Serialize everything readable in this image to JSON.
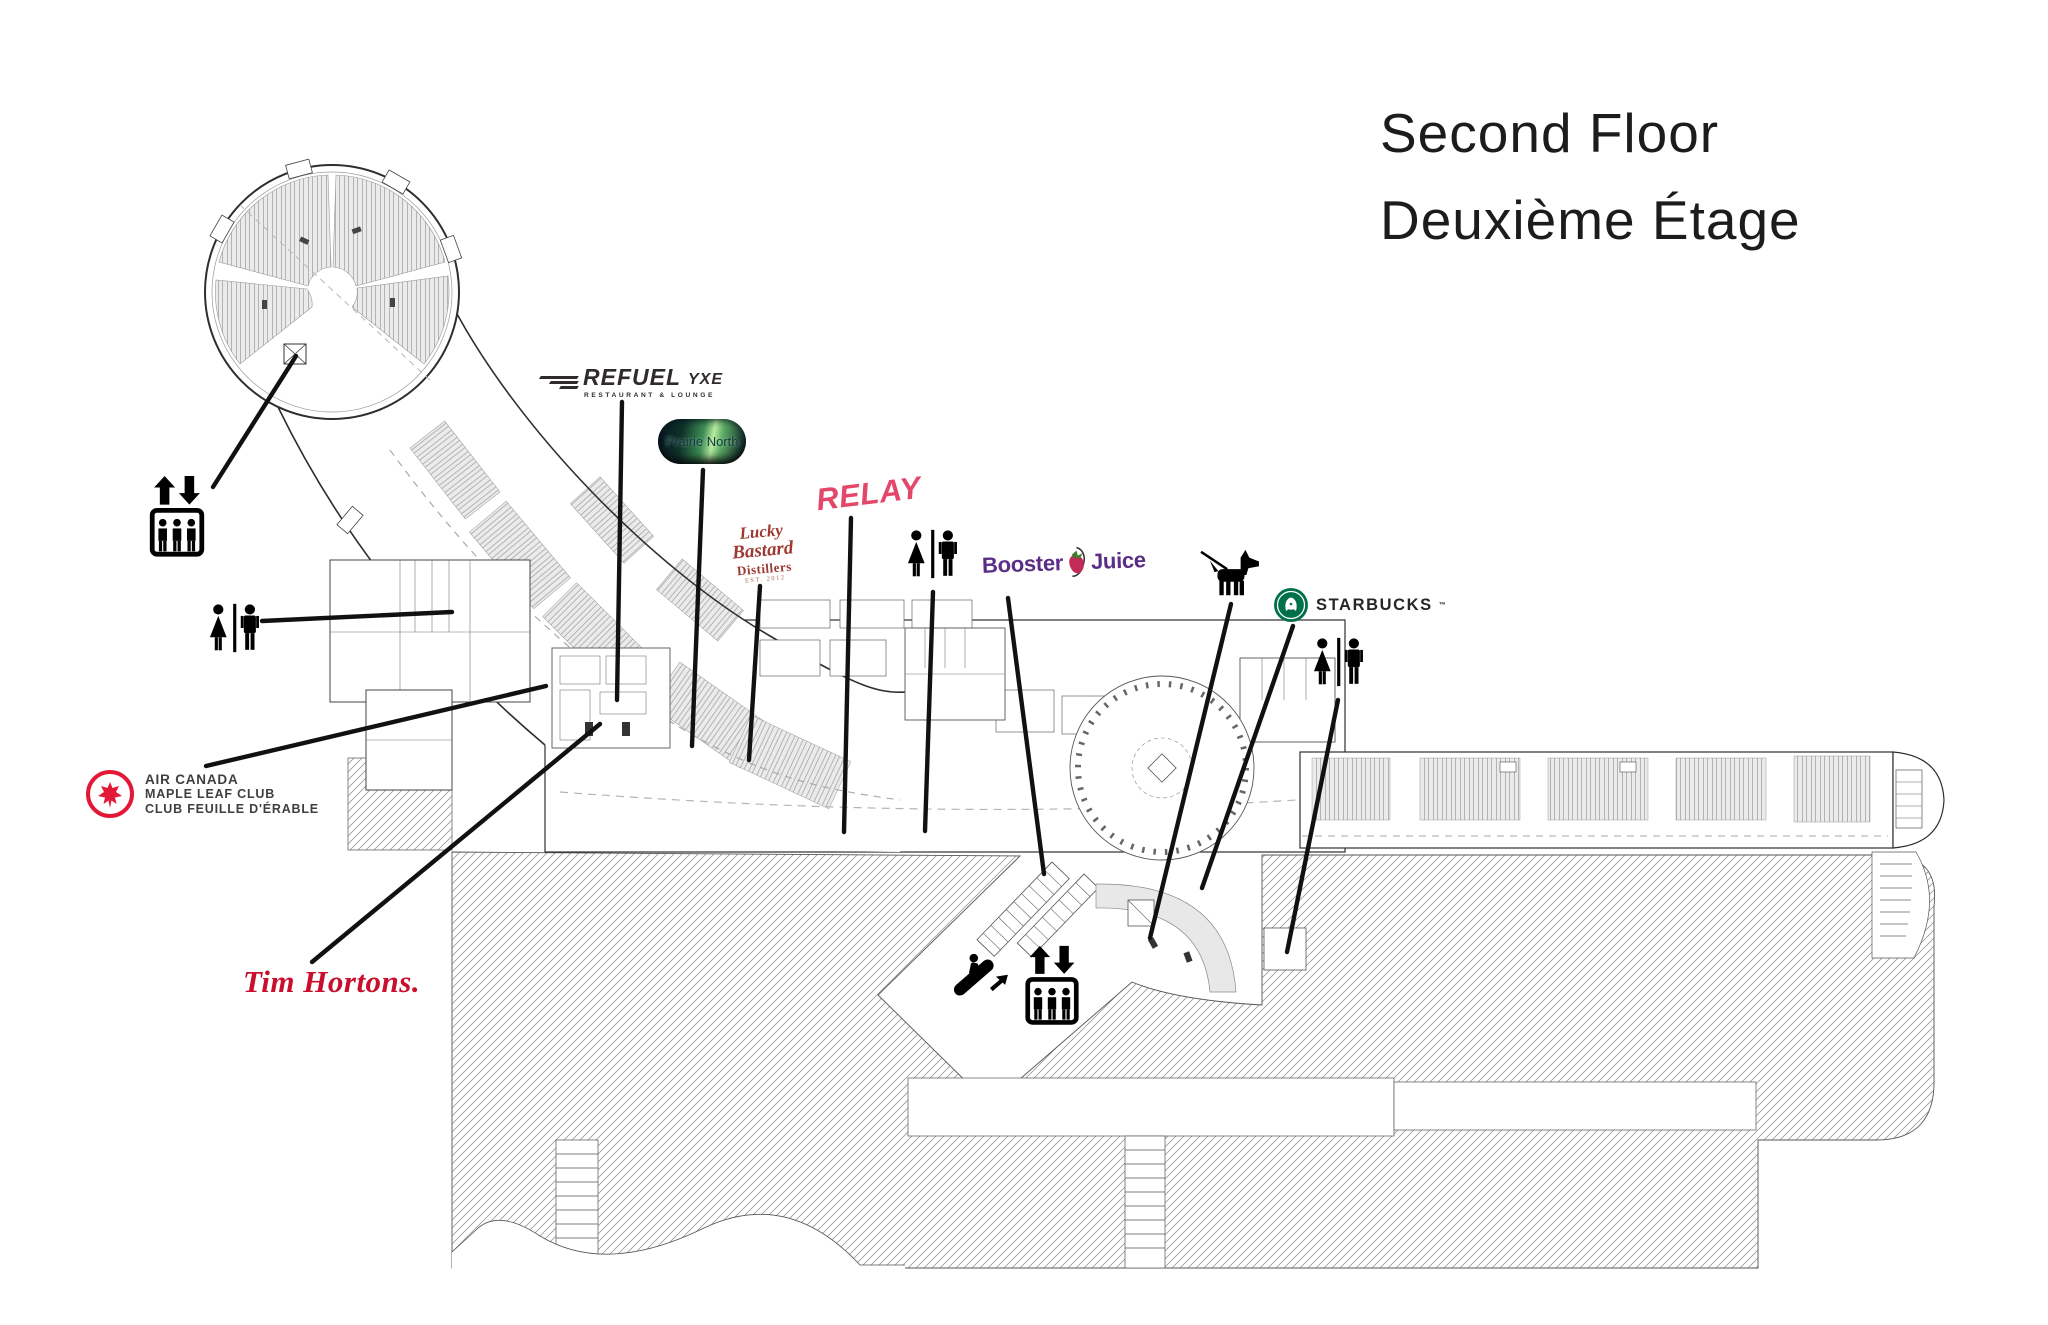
{
  "title": {
    "line1": "Second Floor",
    "line2": "Deuxième Étage"
  },
  "tenants": {
    "refuel": {
      "name": "REFUEL",
      "tagline": "RESTAURANT & LOUNGE",
      "suffix": "YXE"
    },
    "prairie_north": {
      "name": "Prairie North"
    },
    "relay": {
      "name": "RELAY"
    },
    "lucky_bastard": {
      "line1": "Lucky",
      "line2": "Bastard",
      "line3": "Distillers",
      "line4": "EST. 2012"
    },
    "booster_juice": {
      "word1": "Booster",
      "word2": "Juice"
    },
    "starbucks": {
      "name": "STARBUCKS",
      "trademark": "™"
    },
    "air_canada": {
      "line1": "AIR CANADA",
      "line2": "MAPLE LEAF CLUB",
      "line3": "CLUB FEUILLE D'ÉRABLE"
    },
    "tim_hortons": {
      "name": "Tim Hortons."
    }
  },
  "amenities": [
    {
      "icon": "elevator-icon",
      "area": "rotunda-gates"
    },
    {
      "icon": "washroom-icon",
      "area": "west-rooms"
    },
    {
      "icon": "washroom-icon",
      "area": "central-terminal"
    },
    {
      "icon": "washroom-icon",
      "area": "east-concourse"
    },
    {
      "icon": "pet-relief-icon",
      "area": "east-food-court"
    },
    {
      "icon": "escalator-icon",
      "area": "atrium"
    },
    {
      "icon": "elevator-icon",
      "area": "atrium"
    }
  ],
  "colors": {
    "title_text": "#1c1c1c",
    "plan_line": "#2e2e2e",
    "hatch_line": "#8a8a8a",
    "seating_fill": "#ebebeb",
    "relay_red": "#e3476a",
    "tim_hortons_red": "#c8102e",
    "air_canada_red": "#e31837",
    "lucky_bastard_maroon": "#9d3a33",
    "booster_purple": "#5a2d86",
    "starbucks_green": "#00704a"
  }
}
